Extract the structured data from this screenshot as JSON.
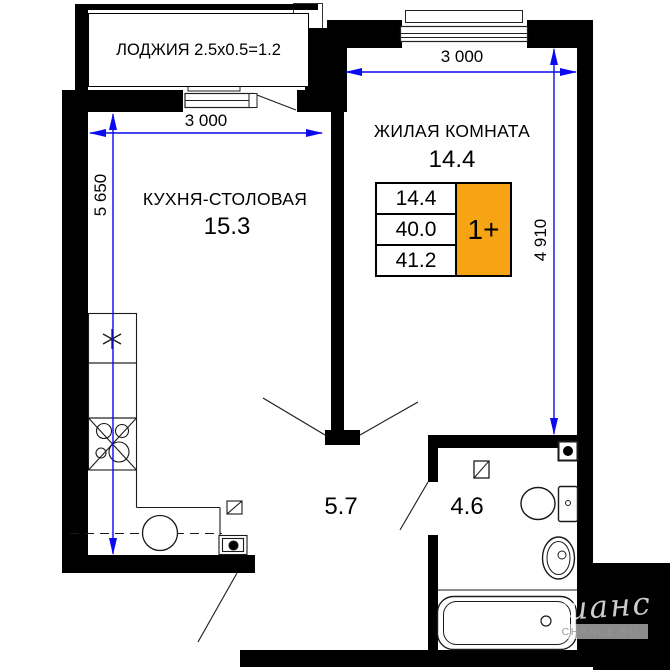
{
  "plan": {
    "loggia_label": "ЛОДЖИЯ 2.5x0.5=1.2",
    "rooms": {
      "kitchen": {
        "name": "КУХНЯ-СТОЛОВАЯ",
        "area": "15.3"
      },
      "living": {
        "name": "ЖИЛАЯ КОМНАТА",
        "area": "14.4"
      },
      "hallway": {
        "area": "5.7"
      },
      "bathroom": {
        "area": "4.6"
      }
    },
    "info_table": {
      "room_area": "14.4",
      "living_area": "40.0",
      "total_area": "41.2",
      "plan_type": "1+"
    },
    "dimensions": {
      "kitchen_width": "3 000",
      "kitchen_height": "5 650",
      "living_width": "3 000",
      "living_height": "4 910"
    },
    "colors": {
      "dimension_blue": "#0a0aee",
      "tag_orange": "#F7A414",
      "wall_black": "#000000"
    },
    "watermark": {
      "script": "шанс",
      "caption": "CHANCE.RU"
    }
  }
}
